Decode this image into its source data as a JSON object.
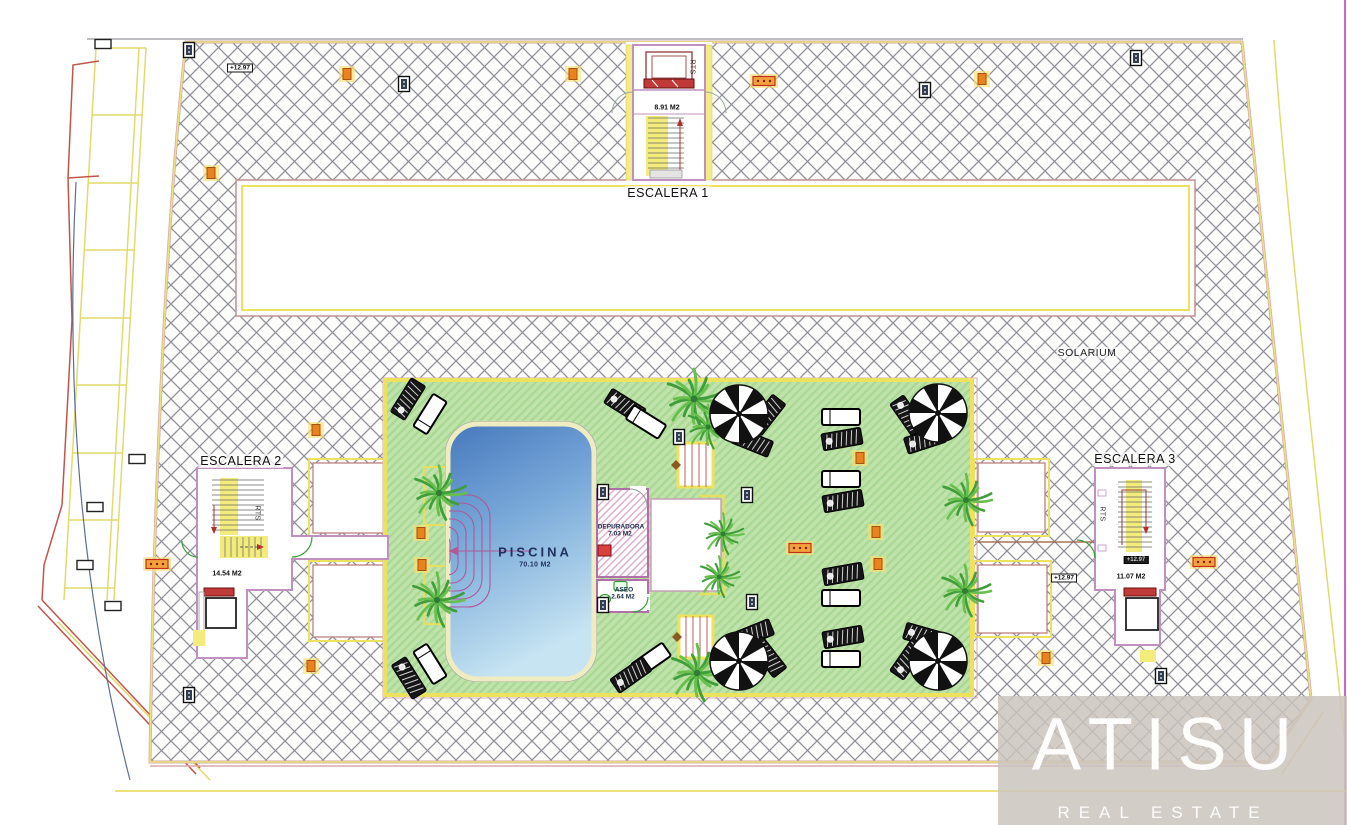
{
  "plan": {
    "labels": {
      "escalera1": "ESCALERA 1",
      "escalera2": "ESCALERA 2",
      "escalera3": "ESCALERA 3",
      "solarium": "SOLARIUM",
      "piscina": "PISCINA",
      "piscina_area": "70.10 M2",
      "escalera1_area": "8.91 M2",
      "escalera2_area": "14.54 M2",
      "escalera3_area": "11.07 M2",
      "depuradora": "DEPURADORA",
      "depuradora_area": "7.03 M2",
      "aseo": "ASEO",
      "aseo_area": "2.64 M2",
      "rts": "RTS",
      "elevation": "+12.97"
    },
    "colors": {
      "hatch_line": "#90909a",
      "border_yellow": "#ece25e",
      "wall_pink": "#c090c0",
      "deck_green": "#bfe3aa",
      "pool_blue": "#4678bd",
      "steps_magenta": "#b05898",
      "door_red": "#c03a3a",
      "marker_orange": "#e8831e",
      "marker_navy": "#333d52",
      "palm_green": "#3f9e3a"
    },
    "palms": [
      {
        "x": 439,
        "y": 493,
        "s": 1.05
      },
      {
        "x": 437,
        "y": 600,
        "s": 1.05
      },
      {
        "x": 694,
        "y": 399,
        "s": 1.15
      },
      {
        "x": 708,
        "y": 427,
        "s": 0.85
      },
      {
        "x": 697,
        "y": 673,
        "s": 1.1
      },
      {
        "x": 723,
        "y": 534,
        "s": 0.8
      },
      {
        "x": 719,
        "y": 577,
        "s": 0.8
      },
      {
        "x": 966,
        "y": 500,
        "s": 1.0
      },
      {
        "x": 965,
        "y": 591,
        "s": 1.0
      }
    ],
    "parasols": [
      {
        "x": 739,
        "y": 414
      },
      {
        "x": 938,
        "y": 413
      },
      {
        "x": 739,
        "y": 661
      },
      {
        "x": 938,
        "y": 661
      }
    ],
    "sunbeds": [
      {
        "t": "b",
        "x": 408,
        "y": 399,
        "r": -58
      },
      {
        "t": "w",
        "x": 430,
        "y": 414,
        "r": -58
      },
      {
        "t": "b",
        "x": 625,
        "y": 406,
        "r": 32
      },
      {
        "t": "w",
        "x": 646,
        "y": 422,
        "r": 32
      },
      {
        "t": "b",
        "x": 767,
        "y": 415,
        "r": -52
      },
      {
        "t": "b",
        "x": 752,
        "y": 442,
        "r": 22
      },
      {
        "t": "b",
        "x": 908,
        "y": 416,
        "r": 55
      },
      {
        "t": "b",
        "x": 925,
        "y": 440,
        "r": -18
      },
      {
        "t": "w",
        "x": 841,
        "y": 417,
        "r": 0
      },
      {
        "t": "b",
        "x": 842,
        "y": 439,
        "r": -10
      },
      {
        "t": "w",
        "x": 841,
        "y": 479,
        "r": 0
      },
      {
        "t": "b",
        "x": 843,
        "y": 501,
        "r": -10
      },
      {
        "t": "b",
        "x": 843,
        "y": 574,
        "r": -10
      },
      {
        "t": "w",
        "x": 841,
        "y": 598,
        "r": 0
      },
      {
        "t": "b",
        "x": 843,
        "y": 637,
        "r": -10
      },
      {
        "t": "w",
        "x": 841,
        "y": 659,
        "r": 0
      },
      {
        "t": "b",
        "x": 409,
        "y": 678,
        "r": 58
      },
      {
        "t": "w",
        "x": 430,
        "y": 664,
        "r": 58
      },
      {
        "t": "w",
        "x": 651,
        "y": 660,
        "r": -35
      },
      {
        "t": "b",
        "x": 631,
        "y": 675,
        "r": -35
      },
      {
        "t": "b",
        "x": 753,
        "y": 634,
        "r": -22
      },
      {
        "t": "b",
        "x": 768,
        "y": 657,
        "r": 52
      },
      {
        "t": "b",
        "x": 924,
        "y": 636,
        "r": 16
      },
      {
        "t": "b",
        "x": 908,
        "y": 659,
        "r": -55
      }
    ],
    "markers": [
      {
        "t": "orange",
        "x": 347,
        "y": 74
      },
      {
        "t": "orange",
        "x": 573,
        "y": 74
      },
      {
        "t": "orange",
        "x": 982,
        "y": 79
      },
      {
        "t": "orange",
        "x": 211,
        "y": 173
      },
      {
        "t": "orange",
        "x": 316,
        "y": 430
      },
      {
        "t": "orange",
        "x": 421,
        "y": 533
      },
      {
        "t": "orange",
        "x": 422,
        "y": 565
      },
      {
        "t": "orange",
        "x": 311,
        "y": 666
      },
      {
        "t": "orange",
        "x": 1046,
        "y": 658
      },
      {
        "t": "orange",
        "x": 876,
        "y": 532
      },
      {
        "t": "orange",
        "x": 878,
        "y": 564
      },
      {
        "t": "orange",
        "x": 860,
        "y": 458
      },
      {
        "t": "strip",
        "x": 764,
        "y": 81
      },
      {
        "t": "strip",
        "x": 157,
        "y": 564
      },
      {
        "t": "strip",
        "x": 1204,
        "y": 562
      },
      {
        "t": "strip",
        "x": 800,
        "y": 548
      },
      {
        "t": "dark",
        "x": 404,
        "y": 84
      },
      {
        "t": "dark",
        "x": 925,
        "y": 90
      },
      {
        "t": "dark",
        "x": 1136,
        "y": 58
      },
      {
        "t": "dark",
        "x": 189,
        "y": 695
      },
      {
        "t": "dark",
        "x": 1161,
        "y": 676
      },
      {
        "t": "dark",
        "x": 679,
        "y": 437
      },
      {
        "t": "dark",
        "x": 747,
        "y": 495
      },
      {
        "t": "dark",
        "x": 752,
        "y": 602
      },
      {
        "t": "dark",
        "x": 603,
        "y": 492
      },
      {
        "t": "dark",
        "x": 603,
        "y": 605
      },
      {
        "t": "dark",
        "x": 189,
        "y": 50
      },
      {
        "t": "outline",
        "x": 103,
        "y": 44
      },
      {
        "t": "outline",
        "x": 137,
        "y": 459
      },
      {
        "t": "outline",
        "x": 95,
        "y": 507
      },
      {
        "t": "outline",
        "x": 85,
        "y": 565
      },
      {
        "t": "outline",
        "x": 113,
        "y": 606
      }
    ]
  },
  "watermark": {
    "brand": "ATISU",
    "tagline": "REAL ESTATE"
  }
}
